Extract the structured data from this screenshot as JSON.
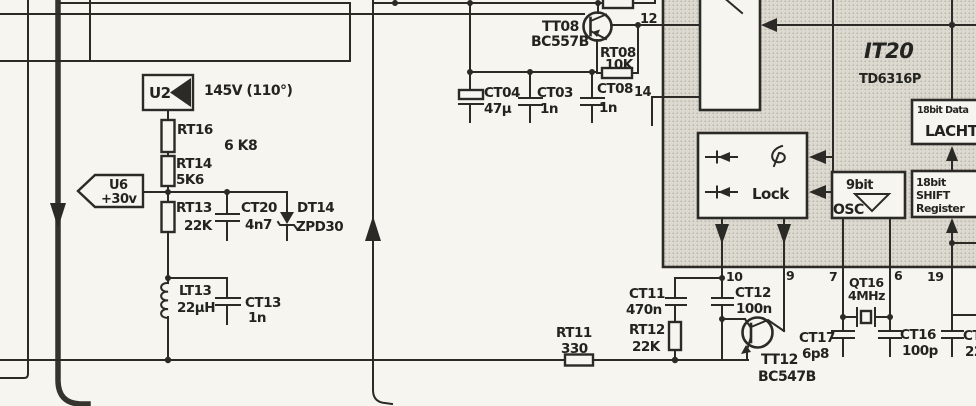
{
  "ic": {
    "ref": "IT20",
    "part": "TD6316P",
    "lock_label": "Lock",
    "osc_bits": "9bit",
    "osc_label": "OSC",
    "latch_bits": "18bit Data",
    "latch_label": "LACHT",
    "shift_bits": "18bit",
    "shift_label": "SHIFT",
    "shift_label2": "Register",
    "pin12": "12",
    "pin14": "14",
    "pin10": "10",
    "pin9": "9",
    "pin7": "7",
    "pin6": "6",
    "pin19": "19"
  },
  "tags": {
    "u2": {
      "label": "U2",
      "note": "145V (110°)"
    },
    "u6": {
      "label": "U6",
      "value": "+30v"
    }
  },
  "parts": {
    "rt16": {
      "ref": "RT16",
      "value": "6 K8"
    },
    "rt14": {
      "ref": "RT14",
      "value": "5K6"
    },
    "rt13": {
      "ref": "RT13",
      "value": "22K"
    },
    "ct20": {
      "ref": "CT20",
      "value": "4n7"
    },
    "dt14": {
      "ref": "DT14",
      "value": "ZPD30"
    },
    "lt13": {
      "ref": "LT13",
      "value": "22µH"
    },
    "ct13": {
      "ref": "CT13",
      "value": "1n"
    },
    "tt08": {
      "ref": "TT08",
      "value": "BC557B"
    },
    "rt08": {
      "ref": "RT08",
      "value": "10K"
    },
    "ct04": {
      "ref": "CT04",
      "value": "47µ"
    },
    "ct03": {
      "ref": "CT03",
      "value": "1n"
    },
    "ct08": {
      "ref": "CT08",
      "value": "1n"
    },
    "rt11": {
      "ref": "RT11",
      "value": "330"
    },
    "rt12": {
      "ref": "RT12",
      "value": "22K"
    },
    "ct11": {
      "ref": "CT11",
      "value": "470n"
    },
    "ct12": {
      "ref": "CT12",
      "value": "100n"
    },
    "tt12": {
      "ref": "TT12",
      "value": "BC547B"
    },
    "ct17": {
      "ref": "CT17",
      "value": "6p8"
    },
    "qt16": {
      "ref": "QT16",
      "value": "4MHz"
    },
    "ct16": {
      "ref": "CT16",
      "value": "100p"
    },
    "ct_clipped": {
      "ref": "CT1",
      "value": "22"
    }
  }
}
